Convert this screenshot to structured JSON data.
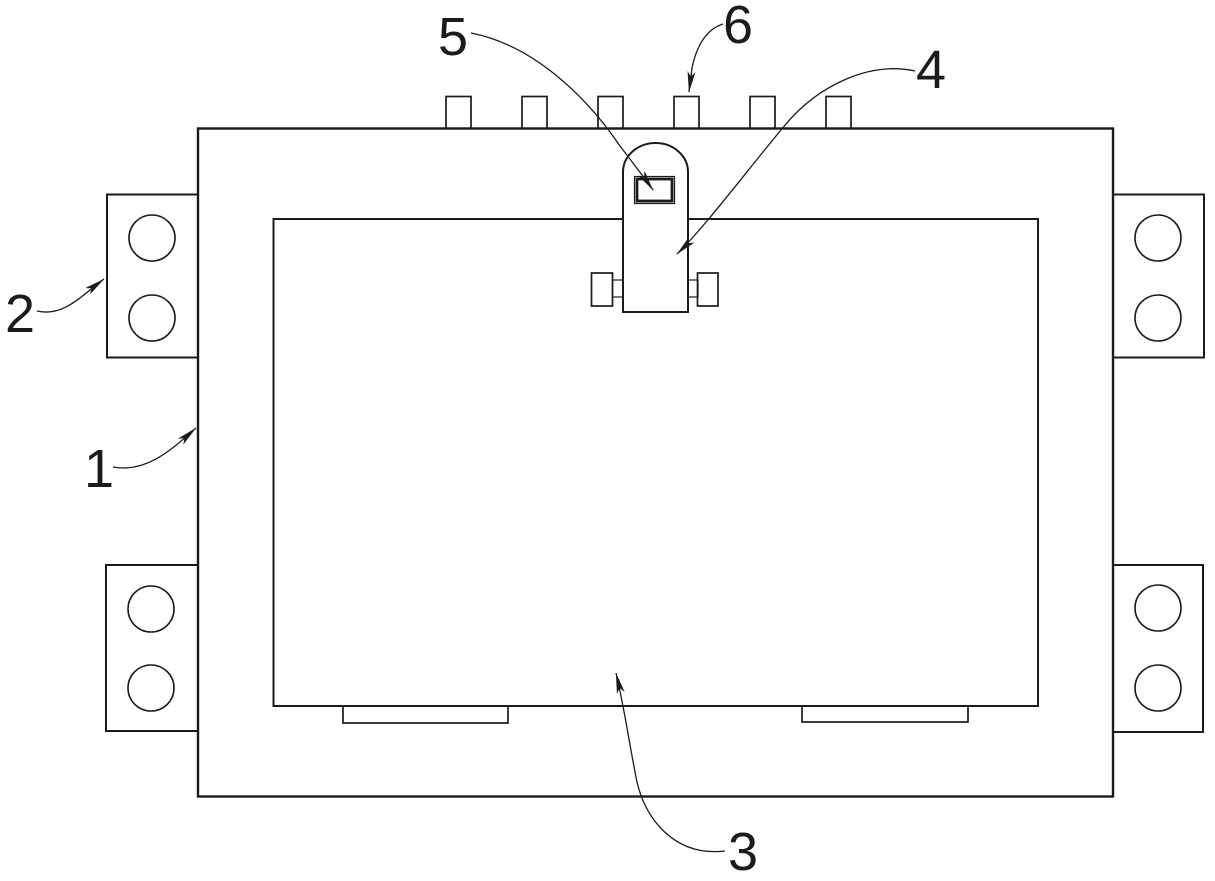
{
  "figure": {
    "background_color": "#ffffff",
    "line_color": "#1b1b1b",
    "reference_numerals": [
      "1",
      "2",
      "3",
      "4",
      "5",
      "6"
    ]
  }
}
